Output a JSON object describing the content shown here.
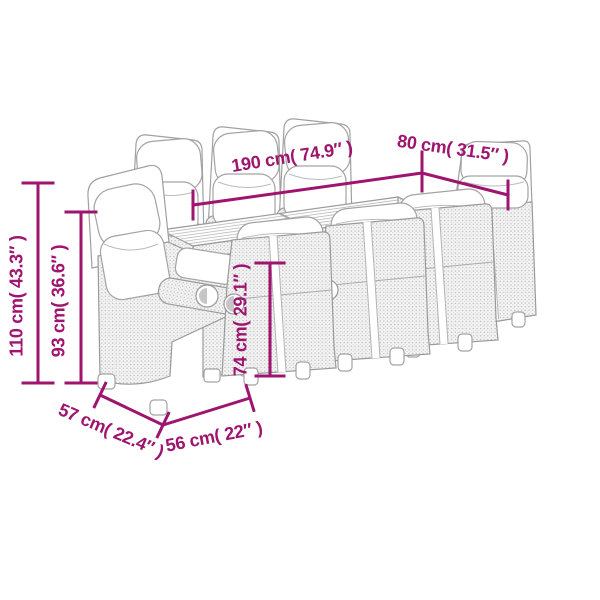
{
  "diagram": {
    "background_color": "#ffffff",
    "accent_color": "#9e146e",
    "sketch_stroke_color": "#9a9a9a",
    "illustration": {
      "description": "Line-art sketch of a rectangular garden dining table with slatted wood top and eight poly-rattan reclining chairs with cushions",
      "table_count": 1,
      "chair_count": 8
    }
  },
  "dimensions": {
    "table_length": {
      "label": "190 cm( 74.9″ )",
      "cm": 190,
      "inches": 74.9
    },
    "table_width": {
      "label": "80 cm( 31.5″ )",
      "cm": 80,
      "inches": 31.5
    },
    "chair_total_height": {
      "label": "110 cm( 43.3″ )",
      "cm": 110,
      "inches": 43.3
    },
    "chair_back_height": {
      "label": "93 cm( 36.6″ )",
      "cm": 93,
      "inches": 36.6
    },
    "table_height": {
      "label": "74 cm( 29.1″ )",
      "cm": 74,
      "inches": 29.1
    },
    "chair_depth": {
      "label": "57 cm( 22.4″ )",
      "cm": 57,
      "inches": 22.4
    },
    "chair_width": {
      "label": "56 cm( 22″ )",
      "cm": 56,
      "inches": 22
    }
  }
}
